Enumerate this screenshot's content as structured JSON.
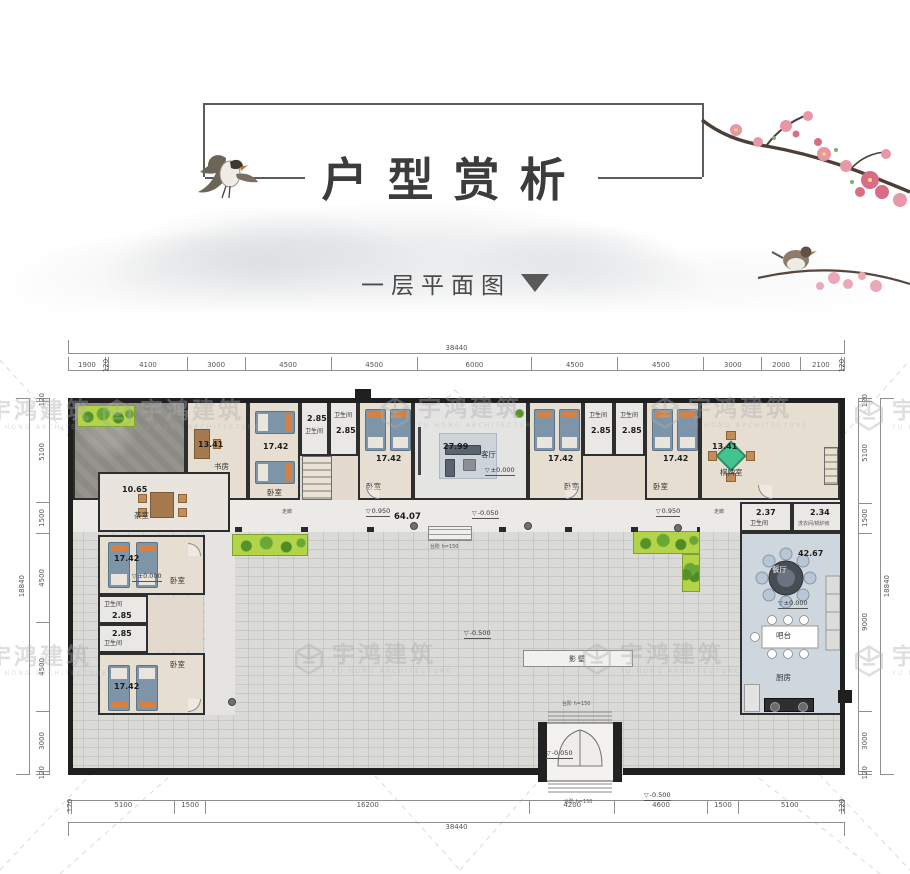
{
  "header": {
    "title": "户型赏析",
    "subtitle": "一层平面图"
  },
  "watermark": {
    "cn": "宇鸿建筑",
    "en": "YU HONG ARCHITECTURE"
  },
  "dimensions": {
    "top": {
      "overall": "38440",
      "segments": [
        "1900",
        "120",
        "4100",
        "3000",
        "4500",
        "4500",
        "6000",
        "4500",
        "4500",
        "3000",
        "2000",
        "2100",
        "120"
      ]
    },
    "bottom": {
      "overall": "38440",
      "segments": [
        "120",
        "5100",
        "1500",
        "16200",
        "4200",
        "4600",
        "1500",
        "5100",
        "120"
      ]
    },
    "left": {
      "overall": "18840",
      "segments": [
        "120",
        "5100",
        "1500",
        "4500",
        "4500",
        "3000",
        "120"
      ]
    },
    "right": {
      "overall": "18840",
      "segments": [
        "120",
        "5100",
        "1500",
        "9000",
        "3000",
        "120"
      ]
    }
  },
  "rooms": {
    "study": {
      "name": "书房",
      "area": "13.41"
    },
    "tea": {
      "name": "茶室",
      "area": "10.65"
    },
    "bedroom": {
      "name": "卧室",
      "area": "17.42"
    },
    "bath": {
      "name": "卫生间",
      "area": "2.85"
    },
    "living": {
      "name": "客厅",
      "area": "27.99"
    },
    "chess": {
      "name": "棋牌室",
      "area": "13.41"
    },
    "dining": {
      "name": "餐厅",
      "area": "42.67"
    },
    "bar": {
      "name": "吧台"
    },
    "kitchen": {
      "name": "厨房"
    },
    "bath_small": {
      "name": "卫生间",
      "area": "2.37"
    },
    "utility": {
      "name": "洗衣间/锅炉房",
      "area": "2.34"
    },
    "corridor": {
      "name": "走廊",
      "area": "64.07"
    },
    "screen_wall": {
      "name": "影壁"
    }
  },
  "levels": {
    "zero": "±0.000",
    "raised": "0.950",
    "minus05": "-0.050",
    "minus50": "-0.500"
  },
  "notes": {
    "steps": "台阶 h=150"
  }
}
